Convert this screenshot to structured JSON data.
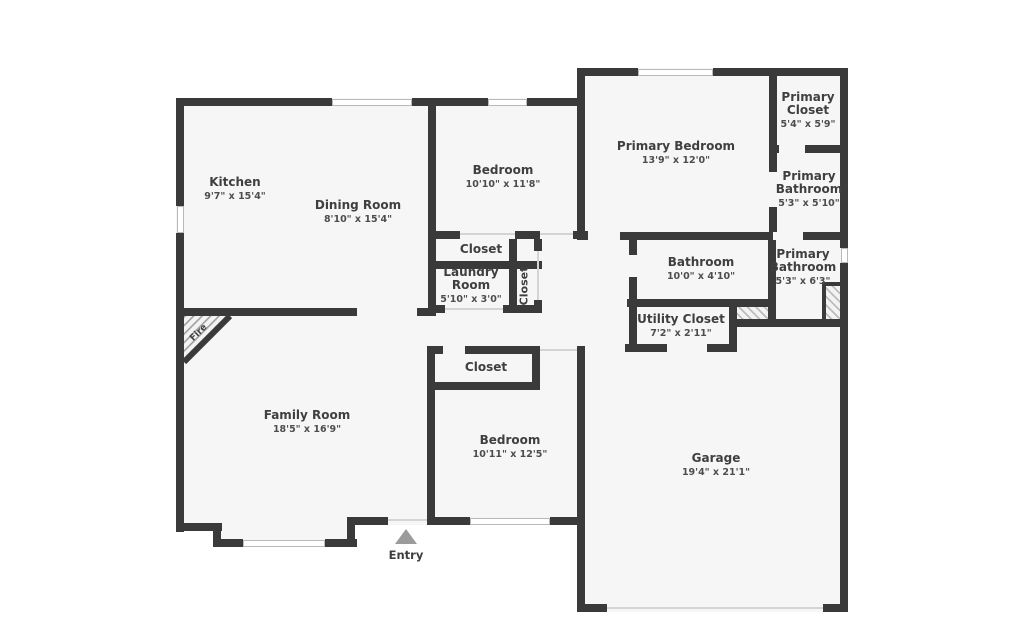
{
  "title": "Floor plan",
  "colors": {
    "wall": "#3a3a3a",
    "floor": "#f6f6f6",
    "label": "#3f3f3f",
    "entry_arrow": "#9b9b9b"
  },
  "rooms": {
    "kitchen": {
      "name": "Kitchen",
      "dims": "9'7\" x 15'4\""
    },
    "dining": {
      "name": "Dining Room",
      "dims": "8'10\" x 15'4\""
    },
    "bedroom_top": {
      "name": "Bedroom",
      "dims": "10'10\" x 11'8\""
    },
    "primary_bedroom": {
      "name": "Primary Bedroom",
      "dims": "13'9\" x 12'0\""
    },
    "primary_closet": {
      "name": "Primary",
      "name2": "Closet",
      "dims": "5'4\" x 5'9\""
    },
    "primary_bath_upper": {
      "name": "Primary",
      "name2": "Bathroom",
      "dims": "5'3\" x 5'10\""
    },
    "closet_hall": {
      "name": "Closet"
    },
    "laundry": {
      "name": "Laundry",
      "name2": "Room",
      "dims": "5'10\" x 3'0\""
    },
    "closet_vertical": {
      "name": "Closet"
    },
    "bathroom": {
      "name": "Bathroom",
      "dims": "10'0\" x 4'10\""
    },
    "primary_bath_lower": {
      "name": "Primary",
      "name2": "Bathroom",
      "dims": "5'3\" x 6'3\""
    },
    "utility_closet": {
      "name": "Utility Closet",
      "dims": "7'2\" x 2'11\""
    },
    "closet_bottom": {
      "name": "Closet"
    },
    "family_room": {
      "name": "Family Room",
      "dims": "18'5\" x 16'9\""
    },
    "bedroom_bottom": {
      "name": "Bedroom",
      "dims": "10'11\" x 12'5\""
    },
    "garage": {
      "name": "Garage",
      "dims": "19'4\" x 21'1\""
    }
  },
  "annotations": {
    "entry": "Entry",
    "fireplace": "Fire"
  }
}
